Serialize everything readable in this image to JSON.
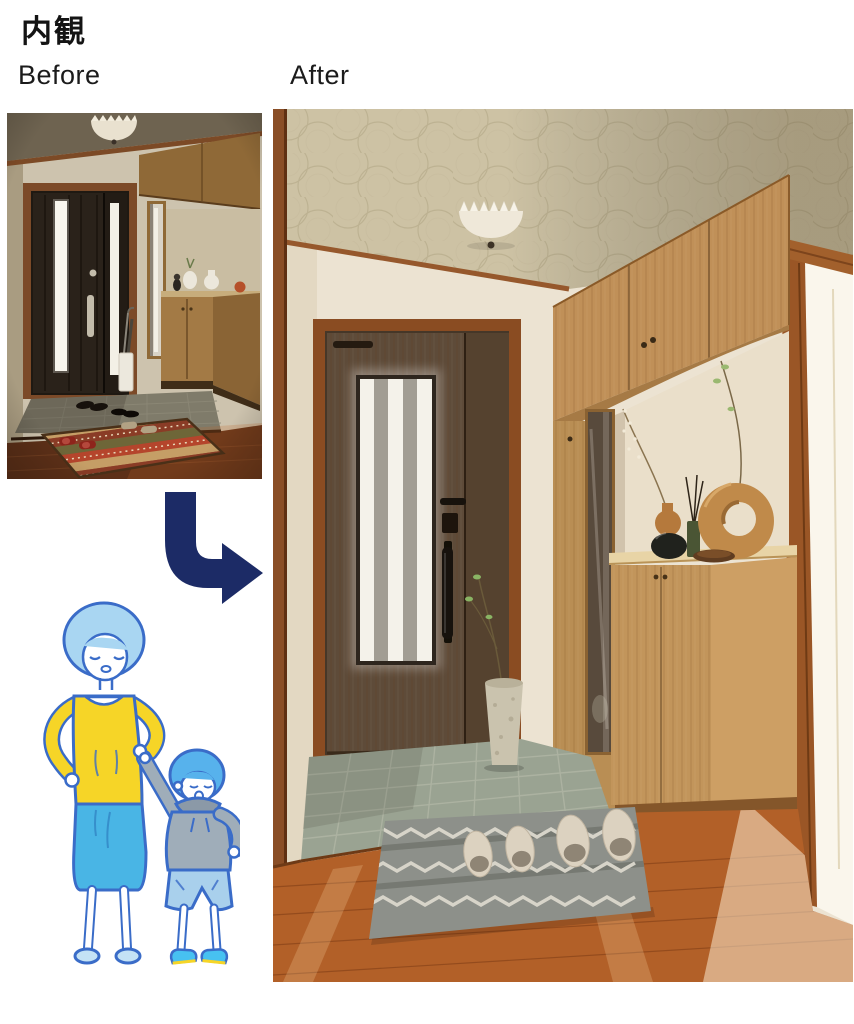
{
  "header": {
    "title": "内観"
  },
  "comparison": {
    "before_label": "Before",
    "after_label": "After",
    "arrow_color": "#1c2b66"
  },
  "photos": {
    "before": {
      "description": "Dim genkan entryway before renovation: black double entrance door with two vertical frosted-glass slits, silver handle, wood shoe cabinets with tall mirror, white vases and cat figurine, umbrella stand, dark tile floor, patterned kilim rug with shoes and red slippers on wood flooring, dome ceiling light"
    },
    "after": {
      "description": "Bright renovated genkan: wood-grain entrance door with vertical slatted frosted glass and black bar handle with keypad lock, floor-to-ceiling light oak storage with overhead bridge cabinet, tall mirror and display counter holding a wooden vase, black vase, reed diffuser, wooden ring sculpture and bowl, branch in tall ceramic planter, patterned ceiling with dome light, grey tile entry step, orange-brown wood floor, grey woven mat with four beige slippers, sunlit open doorway on the right"
    }
  },
  "illustration": {
    "description": "Mother with light-blue bob hair in yellow top and blue skirt holding hands with a young boy in a grey hoodie, light-blue shorts and blue sneakers",
    "colors": {
      "outline": "#3a6cc8",
      "mother_hair": "#a9d6f2",
      "boy_hair": "#57b2ec",
      "top_yellow": "#f6d527",
      "skirt_blue": "#49b5e5",
      "hoodie_gray": "#9fadb9",
      "shorts_blue": "#a9d0ec",
      "sneaker_blue": "#47c1f1"
    }
  },
  "palette": {
    "wood_light": "#c0925a",
    "door_wood": "#5d4a38",
    "door_frame": "#8a4c22",
    "tile_gray": "#9aa392",
    "floor_orange": "#b26028",
    "ceiling_beige": "#cdc2a4",
    "wall_cream": "#ece3d2",
    "arrow_navy": "#1c2b66"
  }
}
